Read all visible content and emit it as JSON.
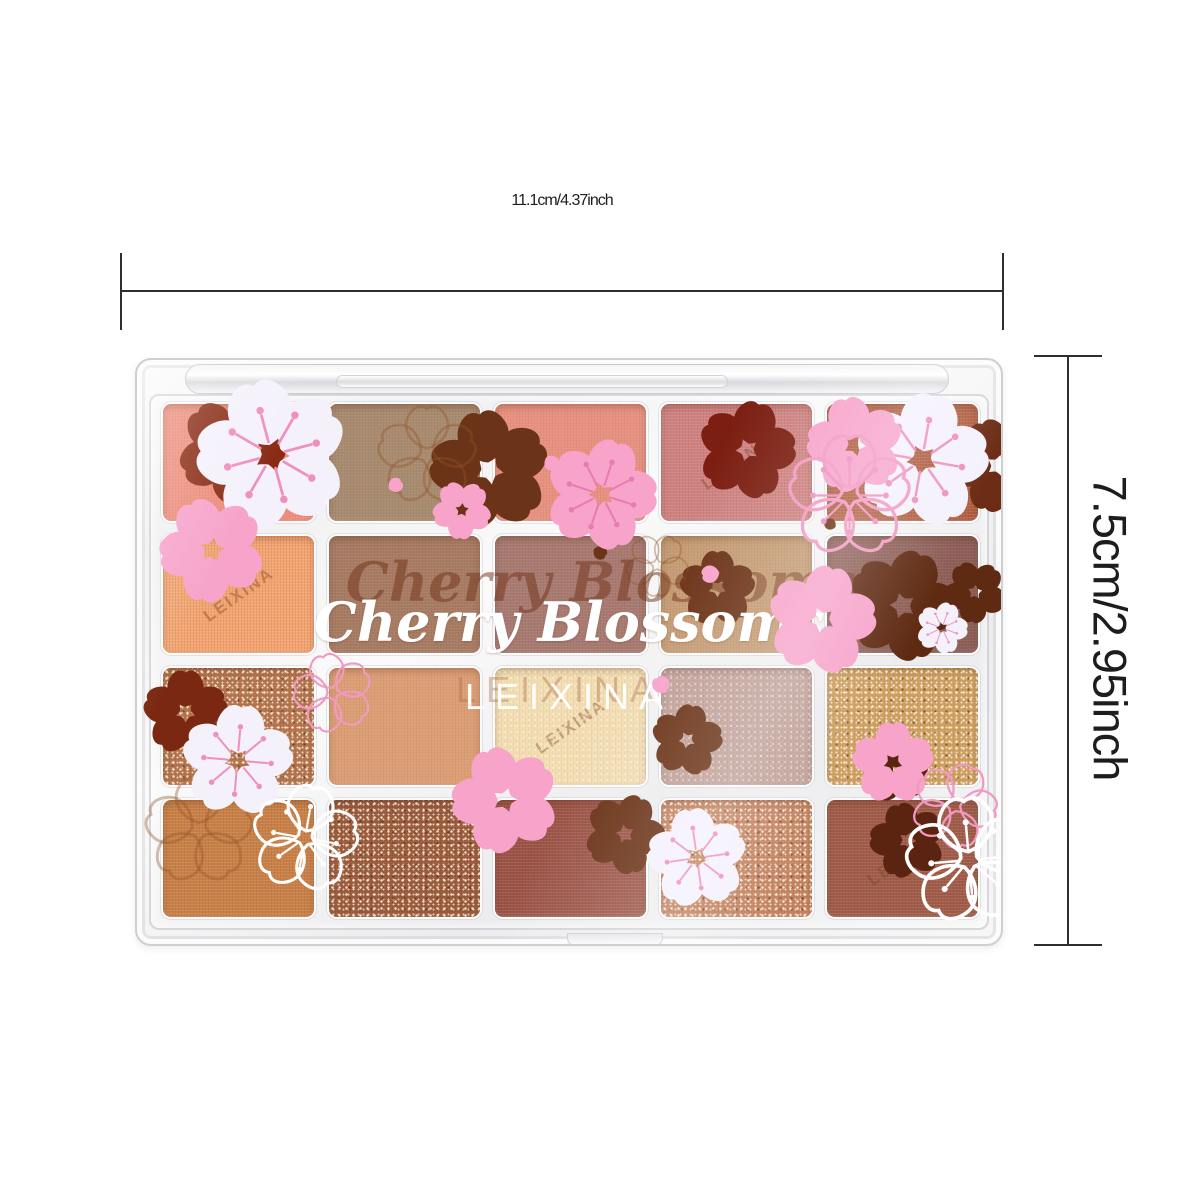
{
  "measurements": {
    "width_label": "11.1cm/4.37inch",
    "height_label": "7.5cm/2.95inch",
    "line_color": "#2e2e2e"
  },
  "product": {
    "brand": "LEIXINA",
    "collection_script": "Cherry Blossoms",
    "pan_count": 20,
    "grid": {
      "rows": 4,
      "cols": 5
    },
    "pans": [
      {
        "row": 1,
        "col": 1,
        "shade": "coral",
        "color": "#ee8d7a",
        "finish": "matte",
        "emboss": "none"
      },
      {
        "row": 1,
        "col": 2,
        "shade": "taupe",
        "color": "#a98b70",
        "finish": "matte",
        "emboss": "flower"
      },
      {
        "row": 1,
        "col": 3,
        "shade": "salmon",
        "color": "#e89180",
        "finish": "matte",
        "emboss": "none"
      },
      {
        "row": 1,
        "col": 4,
        "shade": "rose-pink",
        "color": "#cf8280",
        "finish": "textured",
        "emboss": "brand"
      },
      {
        "row": 1,
        "col": 5,
        "shade": "terracotta",
        "color": "#b25d3f",
        "finish": "textured",
        "emboss": "none"
      },
      {
        "row": 2,
        "col": 1,
        "shade": "peach",
        "color": "#f3a470",
        "finish": "textured",
        "emboss": "brand"
      },
      {
        "row": 2,
        "col": 2,
        "shade": "warm-brown",
        "color": "#a87b63",
        "finish": "matte",
        "emboss": "none"
      },
      {
        "row": 2,
        "col": 3,
        "shade": "mauve-brown",
        "color": "#a87a70",
        "finish": "matte",
        "emboss": "none"
      },
      {
        "row": 2,
        "col": 4,
        "shade": "camel",
        "color": "#c59b72",
        "finish": "matte",
        "emboss": "flower"
      },
      {
        "row": 2,
        "col": 5,
        "shade": "plum-brown",
        "color": "#8e5f57",
        "finish": "matte",
        "emboss": "none"
      },
      {
        "row": 3,
        "col": 1,
        "shade": "copper-glitter",
        "color": "#b4734a",
        "finish": "glitter",
        "emboss": "none"
      },
      {
        "row": 3,
        "col": 2,
        "shade": "apricot",
        "color": "#dc9e75",
        "finish": "matte",
        "emboss": "flower"
      },
      {
        "row": 3,
        "col": 3,
        "shade": "champagne",
        "color": "#f3ddb1",
        "finish": "shimmer",
        "emboss": "brand"
      },
      {
        "row": 3,
        "col": 4,
        "shade": "mauve-shimmer",
        "color": "#c1a098",
        "finish": "shimmer",
        "emboss": "none"
      },
      {
        "row": 3,
        "col": 5,
        "shade": "gold-glitter",
        "color": "#ce9e5d",
        "finish": "glitter",
        "emboss": "none"
      },
      {
        "row": 4,
        "col": 1,
        "shade": "caramel",
        "color": "#c98047",
        "finish": "textured",
        "emboss": "flower"
      },
      {
        "row": 4,
        "col": 2,
        "shade": "bronze-glitter",
        "color": "#9b5a39",
        "finish": "glitter",
        "emboss": "none"
      },
      {
        "row": 4,
        "col": 3,
        "shade": "brick",
        "color": "#9c5346",
        "finish": "textured",
        "emboss": "none"
      },
      {
        "row": 4,
        "col": 4,
        "shade": "rosegold-glitter",
        "color": "#c4815c",
        "finish": "glitter",
        "emboss": "none"
      },
      {
        "row": 4,
        "col": 5,
        "shade": "chestnut",
        "color": "#a15c49",
        "finish": "textured",
        "emboss": "brand"
      }
    ]
  },
  "colors": {
    "blossom_pink": "#f7a3ca",
    "blossom_white": "#f4f1fb",
    "silhouette_brown": "#6b3317",
    "stamen_pink": "#ef8fbe"
  }
}
